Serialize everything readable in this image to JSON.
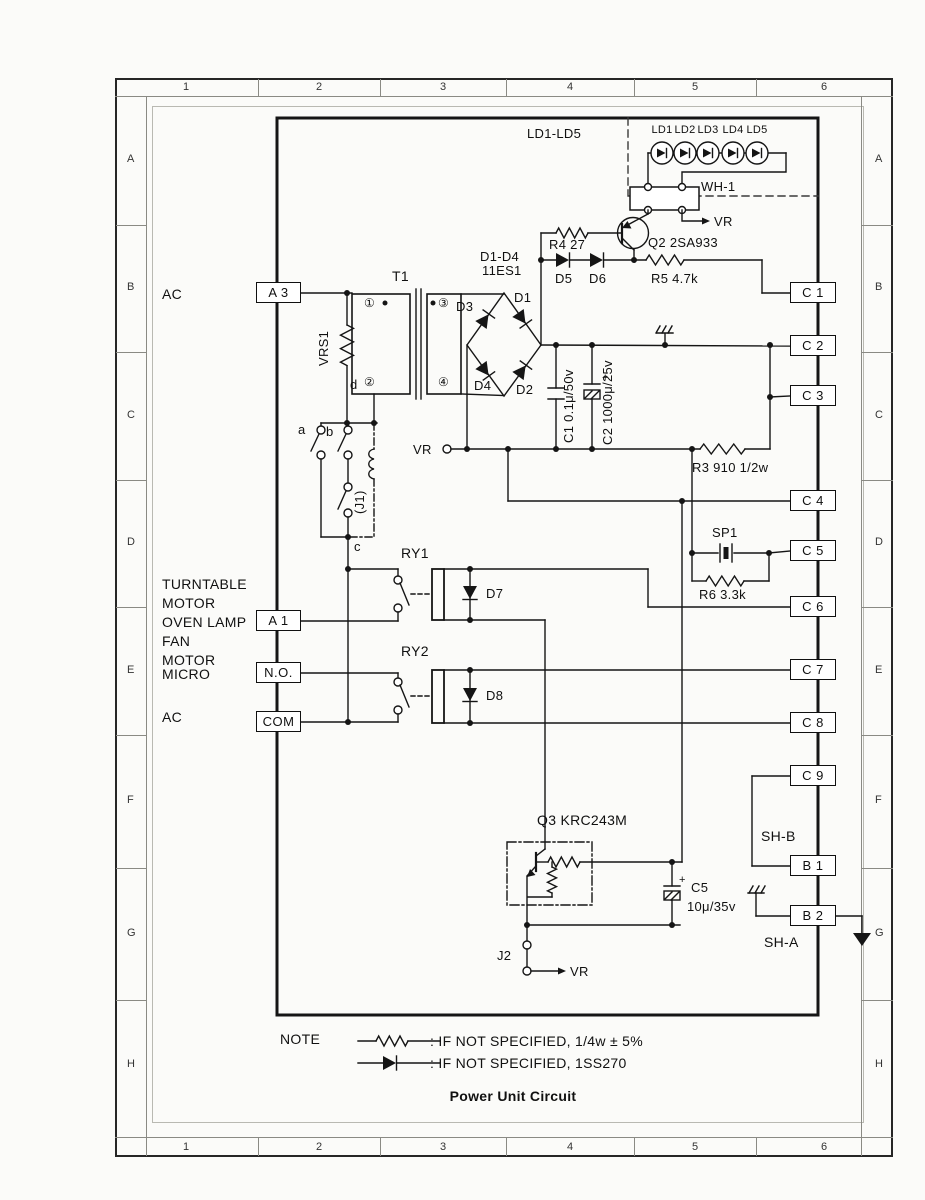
{
  "grid": {
    "cols": [
      "1",
      "2",
      "3",
      "4",
      "5",
      "6"
    ],
    "rows": [
      "A",
      "B",
      "C",
      "D",
      "E",
      "F",
      "G",
      "H"
    ]
  },
  "labels": {
    "ac_top": "AC",
    "loads": [
      "TURNTABLE",
      "MOTOR",
      "OVEN LAMP",
      "FAN",
      "MOTOR"
    ],
    "micro": "MICRO",
    "ac_bottom": "AC"
  },
  "connectors": {
    "a3": "A 3",
    "a1": "A 1",
    "no": "N.O.",
    "com": "COM",
    "c": [
      "C 1",
      "C 2",
      "C 3",
      "C 4",
      "C 5",
      "C 6",
      "C 7",
      "C 8",
      "C 9"
    ],
    "b1": "B 1",
    "b2": "B 2"
  },
  "components": {
    "t1": "T1",
    "vrs1": "VRS1",
    "sw_a": "a",
    "sw_b": "b",
    "node_c": "c",
    "node_d": "d",
    "term1": "①",
    "term2": "②",
    "term3": "③",
    "term4": "④",
    "j1": "(J1)",
    "j2": "J2",
    "ry1": "RY1",
    "ry2": "RY2",
    "d1": "D1",
    "d2": "D2",
    "d3": "D3",
    "d4": "D4",
    "d5": "D5",
    "d6": "D6",
    "d7": "D7",
    "d8": "D8",
    "bridge_name": "D1-D4",
    "bridge_part": "11ES1",
    "q2": "Q2 2SA933",
    "q3": "Q3 KRC243M",
    "r3": "R3 910 1/2w",
    "r4": "R4 27",
    "r5": "R5 4.7k",
    "r6": "R6 3.3k",
    "c1": "C1 0.1μ/50v",
    "c2": "C2 1000μ/25v",
    "c5_name": "C5",
    "c5_value": "10μ/35v",
    "plus": "+",
    "sp1": "SP1",
    "wh1": "WH-1",
    "led_group": "LD1-LD5",
    "leds": [
      "LD1",
      "LD2",
      "LD3",
      "LD4",
      "LD5"
    ],
    "vr": "VR",
    "sh_a": "SH-A",
    "sh_b": "SH-B"
  },
  "note": {
    "heading": "NOTE",
    "resistor_rule": ": IF NOT SPECIFIED,  1/4w ± 5%",
    "diode_rule": ": IF NOT SPECIFIED,  1SS270"
  },
  "title": "Power Unit Circuit"
}
